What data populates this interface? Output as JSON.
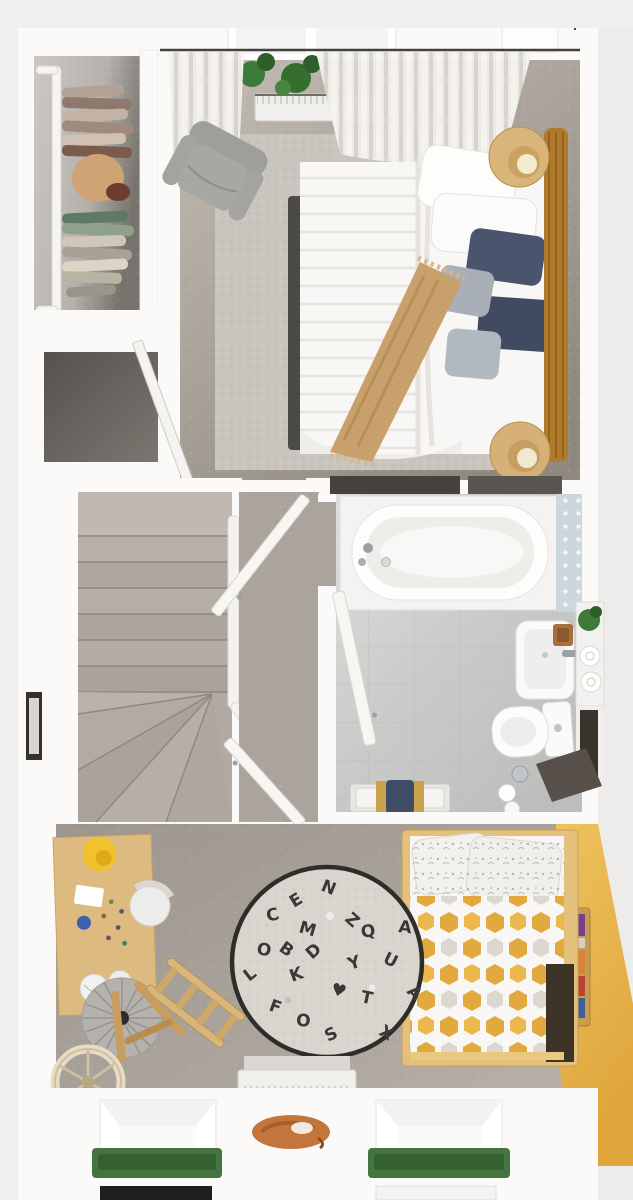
{
  "scene": {
    "title": "3d-floor-plan-first-floor",
    "rooms": {
      "bedroom": "main-bedroom",
      "wardrobe": "walk-in-wardrobe",
      "cupboard": "storage-cupboard",
      "stairs": "winder-staircase",
      "landing": "landing-hall",
      "bathroom": "family-bathroom",
      "kids_room": "children-bedroom"
    },
    "objects": {
      "bedroom": [
        "double-bed",
        "rattan-headboard",
        "bedside-lamp-top",
        "bedside-lamp-bottom",
        "navy-pillows",
        "tan-throw",
        "area-rug",
        "armchair",
        "radiator",
        "curtains",
        "window",
        "plants",
        "leaning-mirror"
      ],
      "wardrobe": [
        "clothes-rail",
        "hanging-clothes-top",
        "hanging-clothes-bottom",
        "shoes"
      ],
      "bathroom": [
        "bathtub",
        "tub-faucet",
        "patterned-tile-strip",
        "washbasin",
        "soap-tray",
        "shelf-unit",
        "towel-rolls",
        "plant",
        "toilet",
        "dark-panel",
        "toilet-roll-holder",
        "spare-rolls",
        "towel-bench",
        "navy-towel",
        "door-leaf"
      ],
      "kids_room": [
        "desk",
        "desk-lamp",
        "desk-chair",
        "pouf",
        "rocking-toy",
        "easel",
        "wheel-toy",
        "alphabet-rug",
        "kids-bed",
        "hexagon-duvet",
        "pillows",
        "bookshelf",
        "yellow-accent-wall",
        "radiator",
        "window-left",
        "window-right",
        "window-boxes",
        "sleeping-cat"
      ]
    }
  },
  "rug_letters": [
    "C",
    "O",
    "N",
    "E",
    "M",
    "Z",
    "Q",
    "U",
    "A",
    "K",
    "T",
    "X",
    "S",
    "F",
    "L",
    "O",
    "Y",
    "A",
    "B",
    "D",
    "♥"
  ],
  "palette": {
    "bg": "#f1f0ee",
    "bg_right": "#edecea",
    "wall": "#fbfaf8",
    "wall_edge": "#e6e3df",
    "carpet_bedroom": "#ada69e",
    "carpet_bedroom_light": "#c3bcb3",
    "carpet_bedroom_dark": "#8f887f",
    "area_rug": "#c9c4bd",
    "carpet_hall": "#aba49c",
    "carpet_kids": "#a9a29a",
    "stairs_base": "#b1aaa2",
    "stairs_line": "#8e877f",
    "closet_floor": "#c6c3be",
    "cupboard_dark": "#686era-3",
    "cupboard_floor": "#6b6661",
    "bath_floor": "#cbcbca",
    "bath_floor_light": "#e0dfdd",
    "tile_blue": "#ccd6dd",
    "tub_white": "#fdfdfc",
    "fixture_white": "#fafaf9",
    "chrome": "#9aa0a4",
    "door_white": "#f7f6f3",
    "curtain_light": "#f0eee8",
    "curtain_dark": "#dbd8d1",
    "radiator": "#f0efec",
    "plant": "#3e7a38",
    "plant_dark": "#2e5e2a",
    "armchair": "#a7a7a4",
    "bed_duvet": "#f8f7f5",
    "bed_frame_dark": "#4c4a47",
    "headboard": "#b07a2c",
    "headboard_line": "#8f5f1e",
    "lamp_wood": "#d9b579",
    "lamp_glow": "#f3ead0",
    "pillow_navy": "#4a546c",
    "pillow_navy2": "#404a61",
    "pillow_gray": "#a9afb8",
    "throw_tan": "#c8a06b",
    "throw_line": "#b08850",
    "wood_desk": "#ddbb80",
    "wood_mid": "#c89d5e",
    "lamp_yellow": "#f2c22e",
    "pouf": "#b5b2ae",
    "rug_base": "#d8d5ce",
    "rug_border": "#2f2d2a",
    "letter": "#3a3834",
    "yellow_wall": "#eaba52",
    "yellow_wall_deep": "#dfa53c",
    "hex_gold": "#e2a93e",
    "hex_silver": "#d8d2c8",
    "kids_bed_wood": "#e3c07b",
    "underbed_dark": "#3e3327",
    "shelf_wood": "#c79c4e",
    "window_green": "#447440",
    "window_green_dark": "#35602f",
    "lower_window_dark": "#1f1e1c",
    "cat": "#c2763b",
    "cat_dark": "#a85f2c",
    "dark_strip": "#45413c",
    "panel_dark": "#3a332c",
    "towel_navy": "#3f4c66",
    "towel_gold": "#c9a24a"
  }
}
